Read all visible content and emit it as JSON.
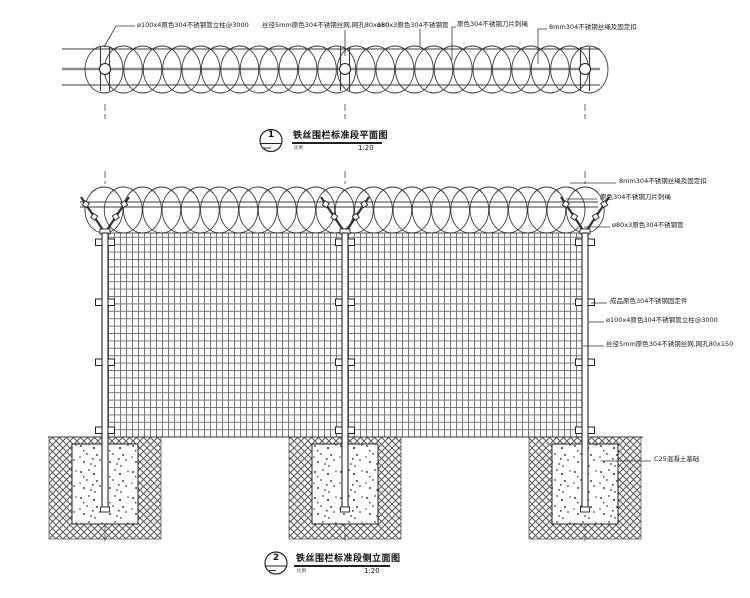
{
  "colors": {
    "line": "#3a3a3a",
    "mesh_line": "#777777",
    "plan_mesh": "#8a8a8a",
    "hatch": "#555555"
  },
  "plan": {
    "labels": [
      {
        "text": "ø100x4原色304不锈钢管立柱@3000"
      },
      {
        "text": "丝径5mm原色304不锈钢丝网,网孔80x150"
      },
      {
        "text": "ø80x3原色304不锈钢管"
      },
      {
        "text": "原色304不锈钢刀片刺绳"
      },
      {
        "text": "8mm304不锈钢丝绳及固定扣"
      }
    ],
    "title": {
      "number": "1",
      "text": "铁丝围栏标准段平面图",
      "scale_label": "比例",
      "scale": "1:20"
    }
  },
  "elevation": {
    "labels": [
      {
        "text": "8mm304不锈钢丝绳及固定扣"
      },
      {
        "text": "原色304不锈钢刀片刺绳"
      },
      {
        "text": "ø80x3原色304不锈钢管"
      },
      {
        "text": "成品原色304不锈钢固定件"
      },
      {
        "text": "ø100x4原色304不锈钢管立柱@3000"
      },
      {
        "text": "丝径5mm原色304不锈钢丝网,网孔80x150"
      },
      {
        "text": "C25混凝土基础"
      }
    ],
    "title": {
      "number": "2",
      "text": "铁丝围栏标准段侧立面图",
      "scale_label": "比例",
      "scale": "1:20"
    }
  }
}
